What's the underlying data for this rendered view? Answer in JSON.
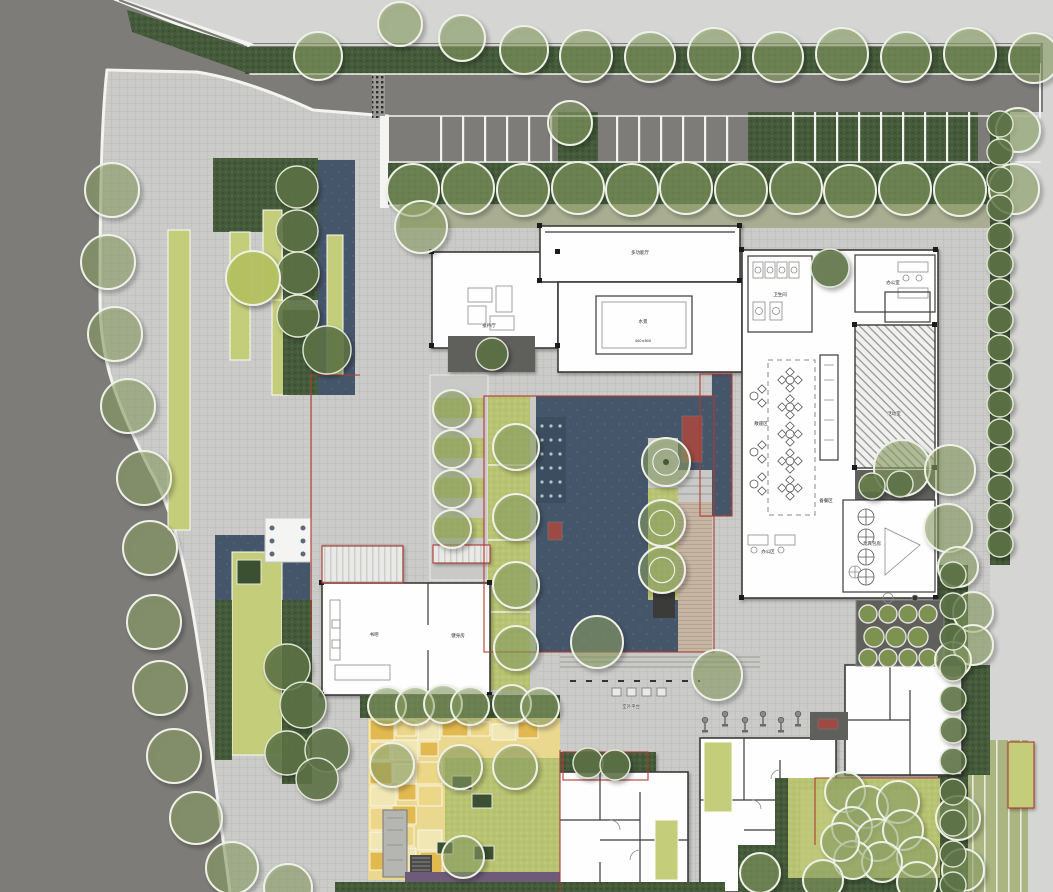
{
  "meta": {
    "plan_type": "landscape-site-master-plan",
    "canvas": {
      "width": 1053,
      "height": 892
    }
  },
  "palette": {
    "road": "#7d7c79",
    "offsite": "#d5d6d4",
    "plaza": "#cbcbc9",
    "plazaline": "#b6b6b3",
    "water": "#46566a",
    "waterdark": "#3d4d60",
    "lime": "#c3cd7a",
    "lawn": "#b9c473",
    "hedge": "#445a3b",
    "sage": "#a9ae92",
    "tree": "#8da368",
    "hedgetree": "#5d7347",
    "wall": "#3a3a38",
    "boundary": "#b03a33",
    "bench": "#9e4a44",
    "deckwood": "#c7b5a4",
    "mosaic1": "#e2b94f",
    "mosaic2": "#ecd687",
    "mosaic3": "#f0e7b4",
    "purple": "#6d5b79"
  },
  "labels": [
    {
      "t": "多功能厅",
      "x": 640,
      "y": 254
    },
    {
      "t": "水景",
      "x": 643,
      "y": 323
    },
    {
      "t": "400×800",
      "x": 643,
      "y": 342,
      "s": 3.5
    },
    {
      "t": "接待厅",
      "x": 489,
      "y": 327
    },
    {
      "t": "卫生间",
      "x": 780,
      "y": 296
    },
    {
      "t": "办公室",
      "x": 893,
      "y": 284
    },
    {
      "t": "散座区",
      "x": 761,
      "y": 425
    },
    {
      "t": "备餐区",
      "x": 826,
      "y": 502
    },
    {
      "t": "活动室",
      "x": 894,
      "y": 415
    },
    {
      "t": "贵宾包房",
      "x": 872,
      "y": 545
    },
    {
      "t": "办公区",
      "x": 768,
      "y": 553
    },
    {
      "t": "书吧",
      "x": 374,
      "y": 636
    },
    {
      "t": "健身房",
      "x": 458,
      "y": 637
    },
    {
      "t": "室外平台",
      "x": 631,
      "y": 708
    }
  ],
  "trees": {
    "light": [
      [
        318,
        56,
        24
      ],
      [
        400,
        24,
        22
      ],
      [
        462,
        38,
        23
      ],
      [
        524,
        50,
        24
      ],
      [
        586,
        56,
        26
      ],
      [
        650,
        57,
        25
      ],
      [
        714,
        54,
        26
      ],
      [
        778,
        57,
        25
      ],
      [
        842,
        54,
        26
      ],
      [
        906,
        57,
        25
      ],
      [
        970,
        54,
        26
      ],
      [
        1034,
        58,
        25
      ],
      [
        570,
        123,
        22
      ],
      [
        1018,
        130,
        22
      ],
      [
        413,
        190,
        26
      ],
      [
        468,
        188,
        26
      ],
      [
        523,
        190,
        26
      ],
      [
        578,
        188,
        26
      ],
      [
        632,
        190,
        26
      ],
      [
        686,
        188,
        26
      ],
      [
        741,
        190,
        26
      ],
      [
        796,
        188,
        26
      ],
      [
        850,
        191,
        26
      ],
      [
        905,
        189,
        26
      ],
      [
        960,
        190,
        26
      ],
      [
        1014,
        189,
        25
      ],
      [
        112,
        190,
        27
      ],
      [
        108,
        262,
        27
      ],
      [
        115,
        334,
        27
      ],
      [
        128,
        406,
        27
      ],
      [
        144,
        478,
        27
      ],
      [
        150,
        548,
        27
      ],
      [
        154,
        622,
        27
      ],
      [
        160,
        688,
        27
      ],
      [
        174,
        756,
        27
      ],
      [
        196,
        818,
        26
      ],
      [
        232,
        868,
        26
      ],
      [
        288,
        888,
        24
      ],
      [
        421,
        227,
        26
      ],
      [
        452,
        409,
        19
      ],
      [
        452,
        449,
        19
      ],
      [
        452,
        489,
        19
      ],
      [
        452,
        529,
        19
      ],
      [
        516,
        447,
        23
      ],
      [
        516,
        517,
        23
      ],
      [
        516,
        585,
        23
      ],
      [
        516,
        648,
        22
      ],
      [
        597,
        642,
        26
      ],
      [
        717,
        675,
        25
      ],
      [
        387,
        706,
        19
      ],
      [
        415,
        706,
        19
      ],
      [
        443,
        704,
        19
      ],
      [
        470,
        706,
        19
      ],
      [
        512,
        704,
        19
      ],
      [
        540,
        707,
        19
      ],
      [
        392,
        765,
        22
      ],
      [
        460,
        767,
        22
      ],
      [
        515,
        767,
        22
      ],
      [
        463,
        857,
        21
      ],
      [
        902,
        468,
        28
      ],
      [
        950,
        470,
        25
      ],
      [
        948,
        528,
        24
      ],
      [
        845,
        792,
        20
      ],
      [
        867,
        807,
        21
      ],
      [
        898,
        802,
        21
      ],
      [
        852,
        827,
        20
      ],
      [
        877,
        840,
        21
      ],
      [
        903,
        830,
        20
      ],
      [
        917,
        857,
        20
      ],
      [
        882,
        862,
        20
      ],
      [
        853,
        860,
        19
      ],
      [
        840,
        842,
        19
      ],
      [
        958,
        818,
        22
      ],
      [
        963,
        870,
        21
      ],
      [
        760,
        873,
        20
      ],
      [
        823,
        880,
        20
      ],
      [
        917,
        882,
        20
      ],
      [
        958,
        567,
        20
      ],
      [
        973,
        612,
        20
      ],
      [
        973,
        645,
        20
      ],
      [
        953,
        660,
        18
      ]
    ],
    "dark": [
      [
        297,
        187,
        21
      ],
      [
        297,
        231,
        21
      ],
      [
        298,
        273,
        21
      ],
      [
        298,
        316,
        21
      ],
      [
        327,
        350,
        24
      ],
      [
        287,
        667,
        23
      ],
      [
        303,
        705,
        23
      ],
      [
        287,
        753,
        22
      ],
      [
        327,
        750,
        22
      ],
      [
        317,
        779,
        21
      ],
      [
        492,
        354,
        16
      ],
      [
        830,
        268,
        19
      ],
      [
        588,
        763,
        15
      ],
      [
        615,
        765,
        15
      ],
      [
        872,
        486,
        13
      ],
      [
        900,
        484,
        13
      ],
      [
        1000,
        124,
        13
      ],
      [
        1000,
        152,
        13
      ],
      [
        1000,
        180,
        13
      ],
      [
        1000,
        208,
        13
      ],
      [
        1000,
        236,
        13
      ],
      [
        1000,
        264,
        13
      ],
      [
        1000,
        292,
        13
      ],
      [
        1000,
        320,
        13
      ],
      [
        1000,
        348,
        13
      ],
      [
        1000,
        376,
        13
      ],
      [
        1000,
        404,
        13
      ],
      [
        1000,
        432,
        13
      ],
      [
        1000,
        460,
        13
      ],
      [
        1000,
        488,
        13
      ],
      [
        1000,
        516,
        13
      ],
      [
        1000,
        544,
        13
      ],
      [
        953,
        575,
        13
      ],
      [
        953,
        606,
        13
      ],
      [
        953,
        637,
        13
      ],
      [
        953,
        668,
        13
      ],
      [
        953,
        699,
        13
      ],
      [
        953,
        730,
        13
      ],
      [
        953,
        761,
        13
      ],
      [
        953,
        792,
        13
      ],
      [
        953,
        823,
        13
      ],
      [
        953,
        854,
        13
      ],
      [
        953,
        885,
        13
      ]
    ],
    "ring": [
      [
        666,
        462,
        24
      ],
      [
        662,
        523,
        23
      ],
      [
        662,
        570,
        23
      ]
    ],
    "lime_tree": [
      [
        253,
        278,
        27
      ]
    ]
  },
  "furniture": {
    "restaurant_tables": [
      [
        790,
        380
      ],
      [
        790,
        407
      ],
      [
        790,
        434
      ],
      [
        790,
        461
      ],
      [
        790,
        488
      ]
    ],
    "side_seats": [
      [
        754,
        396
      ],
      [
        754,
        452
      ],
      [
        754,
        484
      ]
    ],
    "dining_tables": [
      [
        866,
        517
      ],
      [
        866,
        537
      ],
      [
        866,
        557
      ],
      [
        866,
        577
      ]
    ],
    "fitness": [
      [
        705,
        722
      ],
      [
        725,
        716
      ],
      [
        745,
        722
      ],
      [
        763,
        716
      ],
      [
        781,
        722
      ],
      [
        798,
        716
      ]
    ],
    "benches": [
      [
        612,
        688
      ],
      [
        627,
        688
      ],
      [
        642,
        688
      ],
      [
        657,
        688
      ]
    ],
    "planters": [
      [
        868,
        614,
        9
      ],
      [
        888,
        614,
        9
      ],
      [
        908,
        614,
        9
      ],
      [
        928,
        614,
        9
      ],
      [
        874,
        637,
        10
      ],
      [
        896,
        637,
        10
      ],
      [
        918,
        637,
        10
      ],
      [
        868,
        658,
        9
      ],
      [
        888,
        658,
        9
      ],
      [
        908,
        658,
        9
      ],
      [
        928,
        658,
        9
      ]
    ],
    "pergola_dots": [
      [
        272,
        528
      ],
      [
        272,
        541
      ],
      [
        272,
        554
      ],
      [
        303,
        528
      ],
      [
        303,
        541
      ],
      [
        303,
        554
      ]
    ],
    "water_dots": {
      "x0": 542,
      "y0": 426,
      "dx": 9,
      "dy": 14,
      "cols": 3,
      "rows": 6
    }
  },
  "play_patches": [
    [
      370,
      720,
      24,
      20,
      0
    ],
    [
      396,
      720,
      20,
      16,
      1
    ],
    [
      418,
      722,
      22,
      18,
      2
    ],
    [
      442,
      720,
      26,
      16,
      0
    ],
    [
      470,
      722,
      20,
      14,
      1
    ],
    [
      492,
      724,
      24,
      16,
      2
    ],
    [
      518,
      722,
      20,
      16,
      0
    ],
    [
      370,
      742,
      20,
      18,
      1
    ],
    [
      392,
      740,
      26,
      20,
      2
    ],
    [
      420,
      742,
      18,
      14,
      0
    ],
    [
      370,
      762,
      22,
      22,
      0
    ],
    [
      394,
      764,
      20,
      18,
      2
    ],
    [
      416,
      762,
      26,
      22,
      1
    ],
    [
      370,
      786,
      26,
      20,
      2
    ],
    [
      398,
      784,
      18,
      16,
      0
    ],
    [
      418,
      786,
      24,
      20,
      1
    ],
    [
      370,
      808,
      20,
      22,
      1
    ],
    [
      392,
      806,
      24,
      18,
      0
    ],
    [
      370,
      832,
      20,
      18,
      2
    ],
    [
      392,
      826,
      22,
      20,
      1
    ],
    [
      418,
      830,
      24,
      20,
      2
    ],
    [
      370,
      852,
      20,
      18,
      0
    ],
    [
      392,
      848,
      24,
      22,
      2
    ],
    [
      420,
      852,
      22,
      24,
      0
    ]
  ],
  "mosaic_colors": [
    "#e2b94f",
    "#ecd687",
    "#f0e7b4"
  ]
}
